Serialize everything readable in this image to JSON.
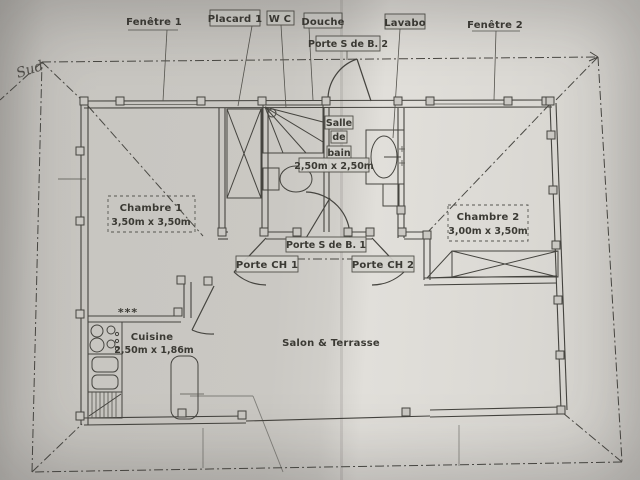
{
  "photo": {
    "compass_label": "Sud"
  },
  "colors": {
    "paper": "#cac8c3",
    "paper_bright": "#e1dfda",
    "ink": "#45443f",
    "label_ink": "#3b3a34"
  },
  "labels": {
    "fenetre1": "Fenêtre 1",
    "placard1": "Placard 1",
    "wc": "W C",
    "douche": "Douche",
    "lavabo": "Lavabo",
    "fenetre2": "Fenêtre 2",
    "porte_sdb2": "Porte S de B. 2",
    "porte_sdb1": "Porte S de B. 1",
    "porte_ch1": "Porte CH 1",
    "porte_ch2": "Porte CH 2"
  },
  "rooms": {
    "chambre1": {
      "name": "Chambre 1",
      "dims": "3,50m x 3,50m"
    },
    "chambre2": {
      "name": "Chambre 2",
      "dims": "3,00m x 3,50m"
    },
    "salle_de_bain": {
      "line1": "Salle",
      "line2": "de",
      "line3": "bain",
      "dims": "2,50m x 2,50m"
    },
    "cuisine": {
      "name": "Cuisine",
      "dims": "2,50m x 1,86m"
    },
    "salon": {
      "name": "Salon & Terrasse"
    }
  },
  "annotations": {
    "stars": "***"
  }
}
